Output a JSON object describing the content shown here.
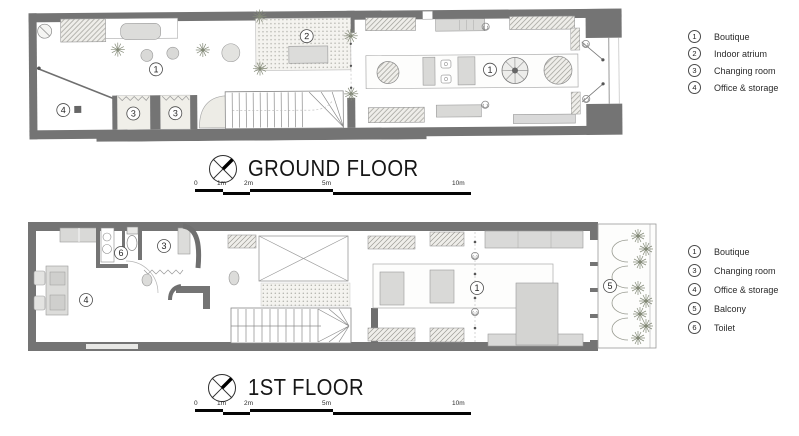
{
  "sheet": {
    "background": "#ffffff"
  },
  "colors": {
    "wall": "#747474",
    "furniture": "#d9d9d7",
    "hatch_line": "#9b9b95",
    "drawing_line": "#555555",
    "plant": "#848a78",
    "text": "#1c1c1c"
  },
  "ground_floor": {
    "title": "GROUND FLOOR",
    "rooms": {
      "boutique_left": "1",
      "atrium": "2",
      "changing_a": "3",
      "changing_b": "3",
      "office": "4",
      "boutique_right": "1"
    },
    "legend": [
      {
        "num": "1",
        "label": "Boutique"
      },
      {
        "num": "2",
        "label": "Indoor atrium"
      },
      {
        "num": "3",
        "label": "Changing room"
      },
      {
        "num": "4",
        "label": "Office & storage"
      }
    ],
    "scale_ticks": [
      "0",
      "1m",
      "2m",
      "5m",
      "10m"
    ]
  },
  "first_floor": {
    "title": "1ST FLOOR",
    "rooms": {
      "boutique": "1",
      "changing": "3",
      "office": "4",
      "balcony": "5",
      "toilet": "6"
    },
    "legend": [
      {
        "num": "1",
        "label": "Boutique"
      },
      {
        "num": "3",
        "label": "Changing room"
      },
      {
        "num": "4",
        "label": "Office & storage"
      },
      {
        "num": "5",
        "label": "Balcony"
      },
      {
        "num": "6",
        "label": "Toilet"
      }
    ],
    "scale_ticks": [
      "0",
      "1m",
      "2m",
      "5m",
      "10m"
    ]
  }
}
